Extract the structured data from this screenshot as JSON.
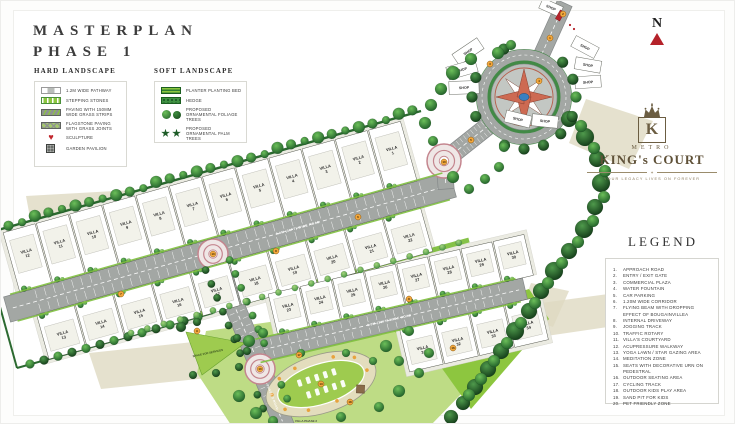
{
  "page": {
    "title_line1": "MASTERPLAN",
    "title_line2": "PHASE 1"
  },
  "north_label": "N",
  "hard_landscape": {
    "heading": "HARD LANDSCAPE",
    "items": [
      {
        "label": "1.2M WIDE PATHWAY",
        "swatch": "pathway"
      },
      {
        "label": "STEPPING STONES",
        "swatch": "stepping-stones"
      },
      {
        "label": "PAVING WITH 150MM WIDE GRASS STRIPS",
        "swatch": "paving-grass-strips"
      },
      {
        "label": "FLAGSTONE PAVING WITH GRASS JOINTS",
        "swatch": "flagstone-paving"
      },
      {
        "label": "SCULPTURE",
        "swatch": "sculpture"
      },
      {
        "label": "GARDEN PAVILION",
        "swatch": "garden-pavilion"
      }
    ]
  },
  "soft_landscape": {
    "heading": "SOFT LANDSCAPE",
    "items": [
      {
        "label": "PLANTER PLANTING BED",
        "swatch": "planter-bed"
      },
      {
        "label": "HEDGE",
        "swatch": "hedge"
      },
      {
        "label": "PROPOSED ORNAMENTAL FOLIAGE TREES",
        "swatch": "foliage-trees"
      },
      {
        "label": "PROPOSED ORNAMENTAL PALM TREES",
        "swatch": "palm-trees"
      }
    ]
  },
  "brand": {
    "metro": "METRO",
    "name": "KING's COURT",
    "monogram": "K",
    "tagline": "YOUR LEGACY LIVES ON FOREVER"
  },
  "legend": {
    "heading": "LEGEND",
    "items": [
      "APPROACH ROAD",
      "ENTRY / EXIT GATE",
      "COMMERCIAL PLAZA",
      "WATER FOUNTAIN",
      "CAR PARKING",
      "1.20M WIDE CORRIDOR",
      "FLYING BEAM WITH DROPPING EFFECT OF BOUGAINVILLEA",
      "INTERNAL DRIVEWAY",
      "JOGGING TRACK",
      "TRAFFIC ROTARY",
      "VILLA'S COURTYARD",
      "ACUPRESSURE WALKWAY",
      "YOGA LAWN / STAR GAZING AREA",
      "MEDITATION ZONE",
      "SEATS WITH DECORATIVE URN ON PEDESTRAL",
      "OUTDOOR SEATING AREA",
      "CYCLING TRACK",
      "OUTDOOR KIDS PLAY AREA",
      "SAND PIT FOR KIDS",
      "PET FRIENDLY ZONE"
    ]
  },
  "plan": {
    "villa_prefix": "VILLA",
    "villa_rows": [
      [
        12,
        11,
        10,
        9,
        8,
        7,
        6,
        5,
        4,
        3,
        2,
        1
      ],
      [
        13,
        14,
        15,
        16,
        17,
        18,
        19,
        20,
        21,
        22
      ],
      [
        23,
        24,
        25,
        26,
        27,
        28,
        29,
        30
      ],
      [
        31,
        32,
        33,
        34
      ]
    ],
    "road_label": "9.0M (30FT) WIDE ROAD",
    "phase2_road_label": "PHASE 2 ROAD",
    "shop_label": "SHOP",
    "services_label": "SPACE FOR SERVICES",
    "phase2_area_label": "VILLA PHASE 2",
    "markers": [
      [
        1,
        549,
        37
      ],
      [
        2,
        562,
        13
      ],
      [
        3,
        489,
        63
      ],
      [
        4,
        538,
        80
      ],
      [
        5,
        470,
        139
      ],
      [
        10,
        443,
        161
      ],
      [
        6,
        357,
        216
      ],
      [
        8,
        275,
        250
      ],
      [
        8,
        408,
        298
      ],
      [
        10,
        212,
        253
      ],
      [
        10,
        259,
        368
      ],
      [
        9,
        196,
        330
      ],
      [
        13,
        320,
        383
      ],
      [
        17,
        298,
        354
      ],
      [
        18,
        349,
        401
      ],
      [
        16,
        452,
        347
      ],
      [
        7,
        120,
        293
      ]
    ]
  },
  "colors": {
    "accent_red": "#b5222a",
    "brand_brown": "#6b5d42",
    "road_gray": "#a3a7a4",
    "tree_green": "#1e5c28",
    "lawn_green": "#bedc85",
    "bright_green": "#7fbf3f",
    "star_red": "#cd6a52",
    "fountain_blue": "#3a7fc1",
    "rotary_pink": "#c4858e",
    "tan": "#ded9c2"
  }
}
